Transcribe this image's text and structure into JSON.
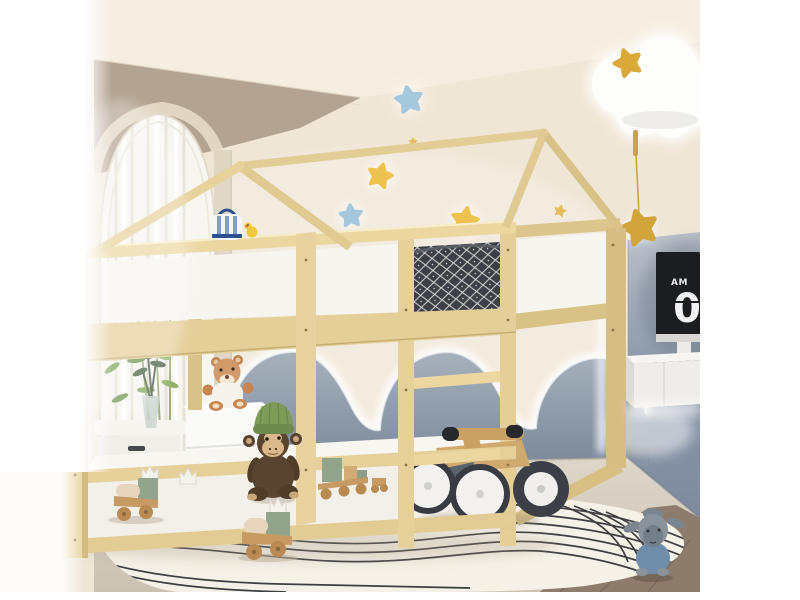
{
  "clock": {
    "meridiem": "AM",
    "digit": "0"
  },
  "palette": {
    "wood": "#e9d49e",
    "wood_shade": "#d5bd84",
    "wall_cream": "#efe6d6",
    "wall_taupe": "#b3a392",
    "wainscot_gray": "#8e99a8",
    "right_wall_blue": "#8c98a9",
    "star_yellow": "#edc24e",
    "star_blue": "#a5c8dc",
    "star_gold": "#d2a43c",
    "rug": "#f5f1e7",
    "rug_line": "#2b2b2f",
    "floor_light": "#d8d0c3",
    "floor_dark": "#8d7b6c",
    "bedding_dark": "#3c3f45",
    "panel_white": "#f7f5f0",
    "monkey_hat_green": "#7e9b59",
    "lamb_blue": "#6f8cab",
    "monitor_black": "#1b1d20"
  },
  "scene": {
    "description": "Kids bedroom with a natural wood house-frame bunk bed, plush toys, glowing cloud and star wall lights, arched curtained window, wavy gray wainscot with LED glow, and a cream rug with wavy black lines",
    "objects": [
      "house-frame bunk bed",
      "top bunk dark patterned bedding",
      "white guardrail panels",
      "ladder",
      "wooden balance bike",
      "white two-drawer nightstand",
      "teddy bear in white shirt",
      "monkey plush with green beanie",
      "wooden toy trains with crown ornaments",
      "blue lamb plush",
      "arched window with sheer curtain",
      "bamboo plant",
      "white storage bench",
      "glass vase with sprigs",
      "cloud wall lamp with yellow star",
      "glowing star night lights",
      "hanging gold star pendant",
      "flip-clock monitor",
      "floating white shelf with keyboard",
      "wavy gray wainscot with LED glow",
      "cream rug with wavy black lines"
    ]
  }
}
